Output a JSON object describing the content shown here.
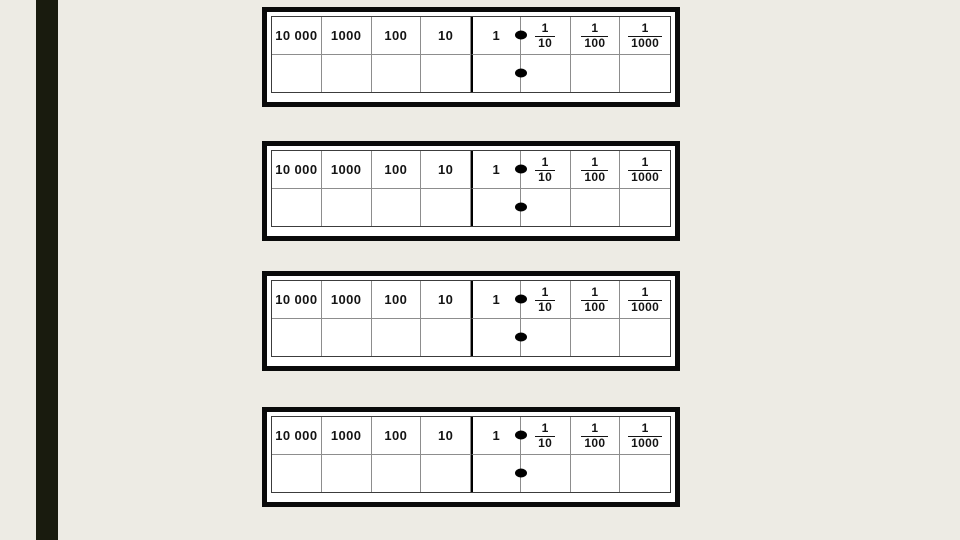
{
  "page": {
    "background_color": "#edebe4",
    "accent_bar_color": "#191b0e",
    "frame_color": "#0a0a0a",
    "grid_line_color": "#8d8d8d",
    "table_border_color": "#3c3c3c",
    "text_color": "#141414",
    "icons": {
      "decimal_point": "filled-oval"
    }
  },
  "charts": [
    {
      "columns": [
        "10 000",
        "1000",
        "100",
        "10",
        "1"
      ],
      "fractions": [
        {
          "numerator": "1",
          "denominator": "10"
        },
        {
          "numerator": "1",
          "denominator": "100"
        },
        {
          "numerator": "1",
          "denominator": "1000"
        }
      ]
    },
    {
      "columns": [
        "10 000",
        "1000",
        "100",
        "10",
        "1"
      ],
      "fractions": [
        {
          "numerator": "1",
          "denominator": "10"
        },
        {
          "numerator": "1",
          "denominator": "100"
        },
        {
          "numerator": "1",
          "denominator": "1000"
        }
      ]
    },
    {
      "columns": [
        "10 000",
        "1000",
        "100",
        "10",
        "1"
      ],
      "fractions": [
        {
          "numerator": "1",
          "denominator": "10"
        },
        {
          "numerator": "1",
          "denominator": "100"
        },
        {
          "numerator": "1",
          "denominator": "1000"
        }
      ]
    },
    {
      "columns": [
        "10 000",
        "1000",
        "100",
        "10",
        "1"
      ],
      "fractions": [
        {
          "numerator": "1",
          "denominator": "10"
        },
        {
          "numerator": "1",
          "denominator": "100"
        },
        {
          "numerator": "1",
          "denominator": "1000"
        }
      ]
    }
  ]
}
